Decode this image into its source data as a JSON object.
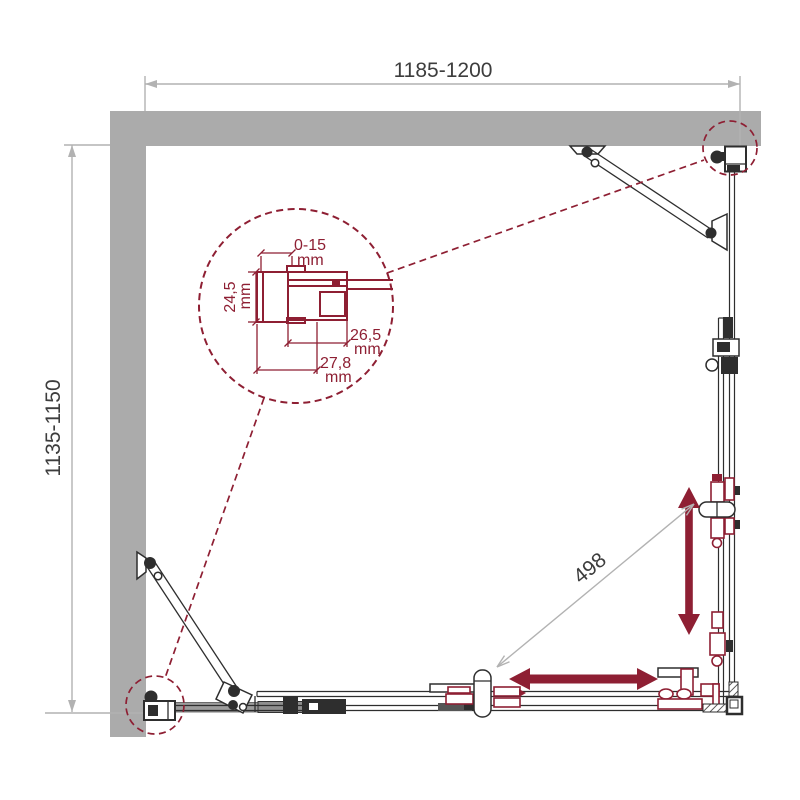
{
  "drawing": {
    "type": "technical-plan-view",
    "subject": "corner shower enclosure with two sliding doors, plan view with wall profile detail",
    "dimensions": {
      "width_range": "1185-1200",
      "depth_range": "1135-1150",
      "door_opening": "498"
    },
    "detail_view": {
      "gap_adjustment": {
        "value": "0-15",
        "unit": "mm"
      },
      "profile_height": {
        "value": "24,5",
        "unit": "mm"
      },
      "pocket_depth": {
        "value": "26,5",
        "unit": "mm"
      },
      "profile_depth": {
        "value": "27,8",
        "unit": "mm"
      }
    },
    "colors": {
      "accent_maroon": "#8e1f33",
      "wall_gray": "#ababab",
      "rail_gray": "#9c9c9c",
      "dim_line_gray": "#b2b2b2",
      "line_dark": "#2e2e2e",
      "text_dark": "#3d3d3d",
      "background": "#ffffff"
    }
  }
}
